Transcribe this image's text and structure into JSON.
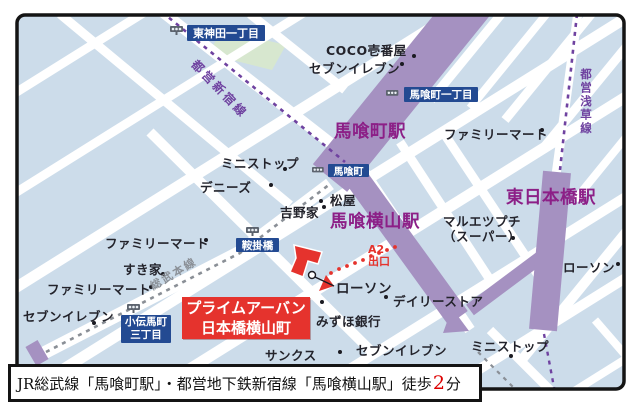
{
  "colors": {
    "block": "#ccdcea",
    "green_block": "#d7e7cf",
    "street": "#ffffff",
    "rail_band": "#a591c1",
    "line_dash": "#6f42a0",
    "jr_dash": "#8a8f96",
    "station_text": "#8c1f87",
    "area_box": "#234a92",
    "red": "#e5332d",
    "poi_text": "#23232b",
    "border": "#141414",
    "footer_minutes": "#dd0000"
  },
  "stations": [
    {
      "label": "馬喰町駅"
    },
    {
      "label": "馬喰横山駅"
    },
    {
      "label": "東日本橋駅"
    }
  ],
  "rail_lines": [
    {
      "label": "都営新宿線"
    },
    {
      "label": "都営浅草線"
    },
    {
      "label": "総武本線"
    }
  ],
  "area_labels": [
    {
      "label": "東神田一丁目"
    },
    {
      "label": "馬喰町一丁目"
    },
    {
      "label": "馬喰町"
    },
    {
      "label": "鞍掛橋"
    },
    {
      "label": "小伝馬町",
      "label2": "三丁目"
    }
  ],
  "pois": [
    {
      "label": "COCO壱番屋"
    },
    {
      "label": "セブンイレブン"
    },
    {
      "label": "ファミリーマート"
    },
    {
      "label": "ミニストップ"
    },
    {
      "label": "デニーズ"
    },
    {
      "label": "吉野家"
    },
    {
      "label": "松屋"
    },
    {
      "label": "ファミリーマート"
    },
    {
      "label": "すき家"
    },
    {
      "label": "ファミリーマート"
    },
    {
      "label": "セブンイレブン"
    },
    {
      "label": "マルエツプチ",
      "label2": "（スーパー）"
    },
    {
      "label": "ローソン"
    },
    {
      "label": "ローソン"
    },
    {
      "label": "デイリーストア"
    },
    {
      "label": "みずほ銀行"
    },
    {
      "label": "サンクス"
    },
    {
      "label": "セブンイレブン"
    },
    {
      "label": "ミニストップ"
    }
  ],
  "property": {
    "line1": "プライムアーバン",
    "line2": "日本橋横山町"
  },
  "exit": {
    "line1": "A2",
    "line2": "出口"
  },
  "footer": {
    "prefix": "JR総武線「馬喰町駅」・都営地下鉄新宿線「馬喰横山駅」徒歩",
    "minutes": "2",
    "suffix": "分"
  }
}
